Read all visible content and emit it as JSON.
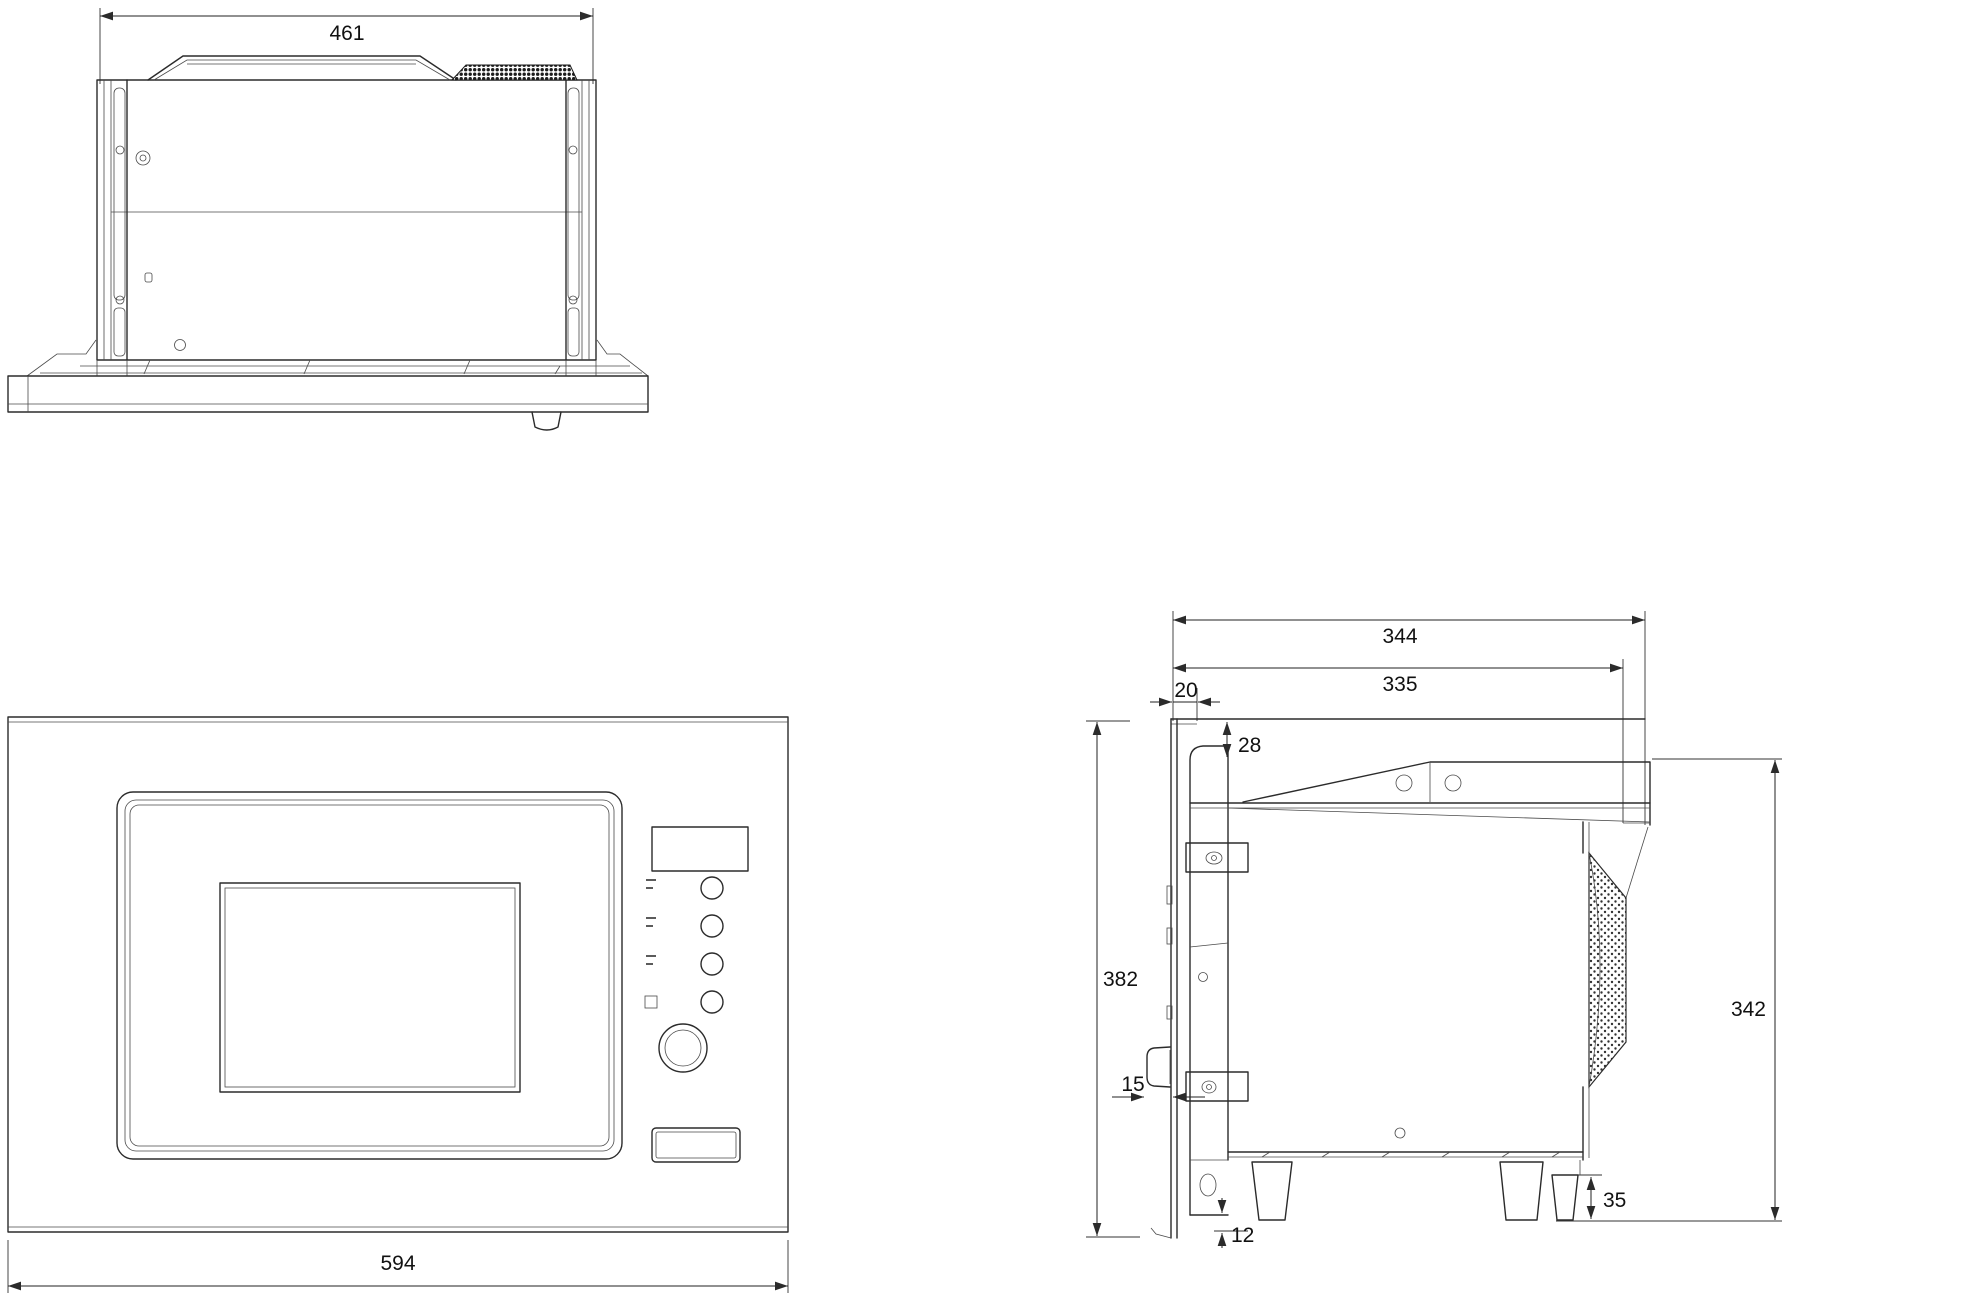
{
  "document": {
    "type": "technical dimensional drawing",
    "subject": "built-in microwave oven with trim frame, three orthographic views"
  },
  "views": {
    "top": {
      "title": "top view",
      "dims": {
        "body_width": "461"
      }
    },
    "front": {
      "title": "front view",
      "dims": {
        "frame_width": "594"
      }
    },
    "side": {
      "title": "side view",
      "dims": {
        "depth_overall": "344",
        "depth_body": "335",
        "front_frame_depth": "20",
        "top_clearance": "28",
        "frame_height": "382",
        "front_knob_protrusion": "15",
        "rear_height": "342",
        "frame_bottom_offset": "12",
        "rear_foot_clearance": "35"
      }
    }
  },
  "colors": {
    "line": "#2b2b2b",
    "dim_text": "#111111",
    "background": "#ffffff"
  }
}
